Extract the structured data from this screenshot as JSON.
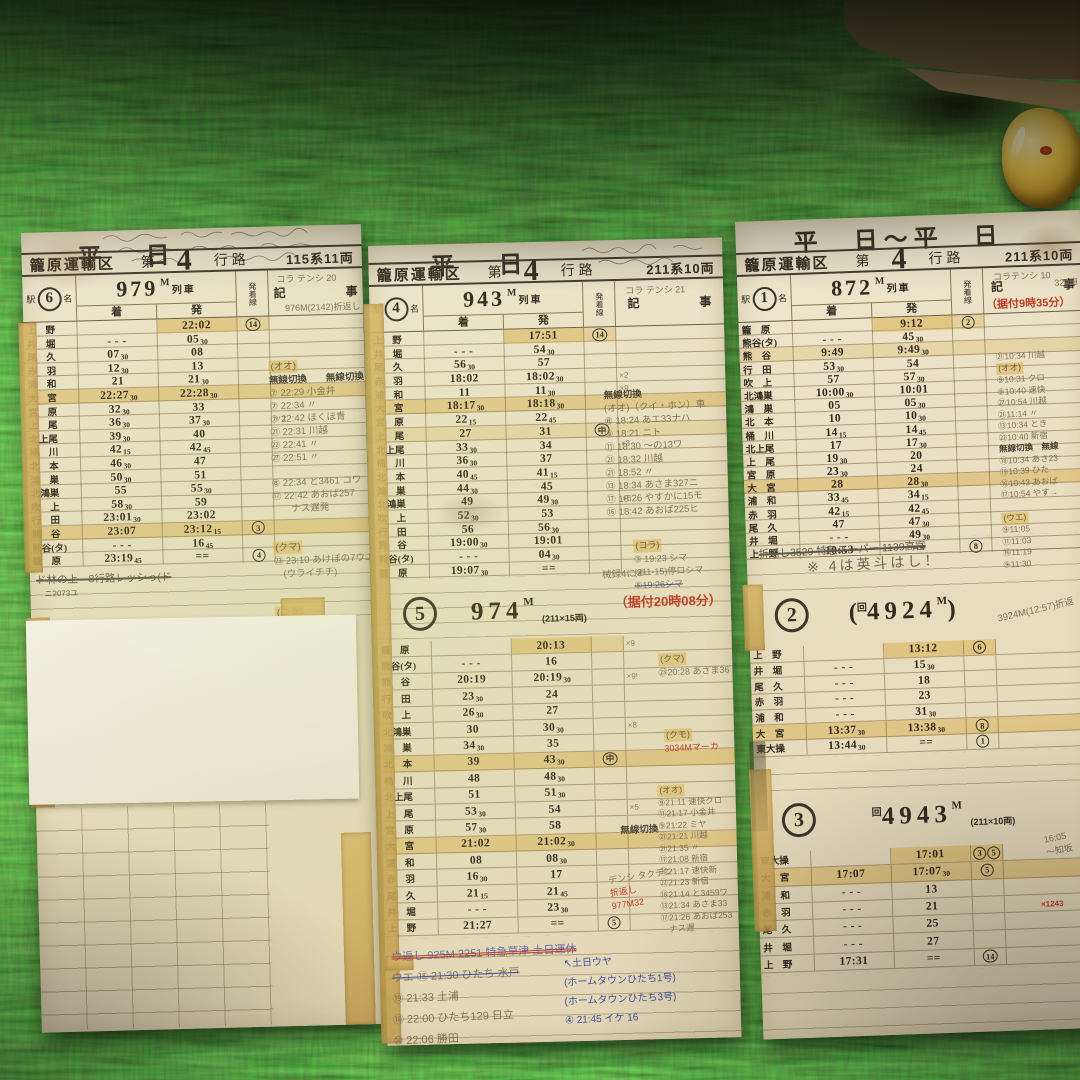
{
  "palette": {
    "carpet": "#2c3a14",
    "card": "#e9dfc3",
    "tape": "#d2ab60",
    "ink": "#33291d",
    "red": "#bf3a27",
    "blue": "#3d4f9e",
    "pencil": "#7d7059"
  },
  "labels": {
    "eki": "駅",
    "mei": "名",
    "arr": "着",
    "dep": "発",
    "track": "発着線",
    "kiji_l": "記",
    "kiji_r": "事",
    "ressha": "列車",
    "m": "M",
    "musen": "無線切換"
  },
  "cards": {
    "left": {
      "title": "平　日",
      "header": {
        "depot": "籠原運輸区",
        "dai": "第",
        "num": "4",
        "koro": "行路",
        "stock": "115系11両"
      },
      "badge": "6",
      "sec1": {
        "train": "979"
      },
      "pencil_top": "コラ テンシ 20",
      "pencil_sub": "976M(2142)折返し",
      "rows": [
        {
          "st": "上　野",
          "d": "22:02",
          "ln": "14",
          "hl": "dep"
        },
        {
          "st": "井　堀",
          "a": "- - -",
          "d": "05",
          "ds": "30"
        },
        {
          "st": "尾　久",
          "a": "07",
          "as": "30",
          "d": "08"
        },
        {
          "st": "赤　羽",
          "a": "12",
          "as": "30",
          "d": "13"
        },
        {
          "st": "浦　和",
          "a": "21",
          "d": "21",
          "ds": "30",
          "m": "19"
        },
        {
          "st": "大　宮",
          "a": "22:27",
          "as": "30",
          "d": "22:28",
          "ds": "30",
          "hl": "row"
        },
        {
          "st": "宮　原",
          "a": "32",
          "as": "30",
          "d": "33"
        },
        {
          "st": "上　尾",
          "a": "36",
          "as": "30",
          "d": "37",
          "ds": "30",
          "m": "〃1"
        },
        {
          "st": "北上尾",
          "a": "39",
          "as": "30",
          "d": "40"
        },
        {
          "st": "桶　川",
          "a": "42",
          "as": "15",
          "d": "42",
          "ds": "45"
        },
        {
          "st": "北　本",
          "a": "46",
          "as": "30",
          "d": "47"
        },
        {
          "st": "鴻　巣",
          "a": "50",
          "as": "30",
          "d": "51"
        },
        {
          "st": "北鴻巣",
          "a": "55",
          "d": "55",
          "ds": "30"
        },
        {
          "st": "吹　上",
          "a": "58",
          "as": "30",
          "d": "59"
        },
        {
          "st": "行　田",
          "a": "23:01",
          "as": "30",
          "d": "23:02"
        },
        {
          "st": "熊　谷",
          "a": "23:07",
          "d": "23:12",
          "ds": "15",
          "ln": "3",
          "hl": "row"
        },
        {
          "st": "熊谷(タ)",
          "a": "- - -",
          "d": "16",
          "ds": "45"
        },
        {
          "st": "籠　原",
          "a": "23:19",
          "as": "45",
          "d": "==",
          "ln": "4"
        }
      ],
      "notes": [
        {
          "t": "(オオ)",
          "c": "hl"
        },
        {
          "t": "無線切換　　無線切換",
          "c": "p2"
        },
        {
          "t": "⑦ 22:29 小金井",
          "c": "p"
        },
        {
          "t": "⑦ 22:34 〃",
          "c": "p"
        },
        {
          "t": "⑦ 22:42 ほくほ青",
          "c": "p"
        },
        {
          "t": "㉑ 22:31 川越",
          "c": "p"
        },
        {
          "t": "㉒ 22:41 〃",
          "c": "p"
        },
        {
          "t": "㉗ 22:51 〃",
          "c": "p"
        },
        {
          "t": "",
          "c": "gap"
        },
        {
          "t": "⑧ 22:34 と3461 コワ",
          "c": "p"
        },
        {
          "t": "⑰ 22:42 あおば257",
          "c": "p"
        },
        {
          "t": "　　ナス遅発",
          "c": "p"
        },
        {
          "t": "",
          "c": "gapL"
        },
        {
          "t": "(クマ)",
          "c": "hl"
        },
        {
          "t": "㉓ 23:10 あけぼの7ウエ",
          "c": "p"
        },
        {
          "t": "　(ウライチチ)",
          "c": "p"
        },
        {
          "t": "",
          "c": "gapL"
        },
        {
          "t": "(コラ)",
          "c": "hl"
        },
        {
          "t": "③ 23:28 折返",
          "c": "p"
        },
        {
          "t": "(211-10)停マ",
          "c": "r"
        }
      ],
      "under_note": "ド林の上　8行路レッシっ(ド",
      "under_note2": "ニ2073ユ",
      "tape_label": "20"
    },
    "middle": {
      "title": "平　日",
      "header": {
        "depot": "籠原運輸区",
        "dai": "第",
        "num": "4",
        "koro": "行路",
        "stock": "211系10両"
      },
      "badge": "4",
      "sec1": {
        "train": "943"
      },
      "pencil_top": "コラ テンシ 21",
      "rows": [
        {
          "st": "上　野",
          "d": "17:51",
          "ln": "14",
          "hl": "dep"
        },
        {
          "st": "井　堀",
          "a": "- - -",
          "d": "54",
          "ds": "30"
        },
        {
          "st": "尾　久",
          "a": "56",
          "as": "30",
          "d": "57"
        },
        {
          "st": "赤　羽",
          "a": "18:02",
          "d": "18:02",
          "ds": "30",
          "m": "×2"
        },
        {
          "st": "浦　和",
          "a": "11",
          "d": "11",
          "ds": "30",
          "m": "×9"
        },
        {
          "st": "大　宮",
          "a": "18:17",
          "as": "30",
          "d": "18:18",
          "ds": "30",
          "hl": "row"
        },
        {
          "st": "宮　原",
          "a": "22",
          "as": "15",
          "d": "22",
          "ds": "45"
        },
        {
          "st": "上　尾",
          "a": "27",
          "d": "31",
          "ln": "中",
          "hl": "rowlight"
        },
        {
          "st": "北上尾",
          "a": "33",
          "as": "30",
          "d": "34",
          "m": "×3"
        },
        {
          "st": "桶　川",
          "a": "36",
          "as": "30",
          "d": "37"
        },
        {
          "st": "北　本",
          "a": "40",
          "as": "45",
          "d": "41",
          "ds": "15"
        },
        {
          "st": "鴻　巣",
          "a": "44",
          "as": "30",
          "d": "45"
        },
        {
          "st": "北鴻巣",
          "a": "49",
          "d": "49",
          "ds": "30",
          "m": "×5"
        },
        {
          "st": "吹　上",
          "a": "52",
          "as": "30",
          "d": "53"
        },
        {
          "st": "行　田",
          "a": "56",
          "d": "56",
          "ds": "30"
        },
        {
          "st": "熊　谷",
          "a": "19:00",
          "as": "30",
          "d": "19:01"
        },
        {
          "st": "熊谷(タ)",
          "a": "- - -",
          "d": "04",
          "ds": "30"
        },
        {
          "st": "籠　原",
          "a": "19:07",
          "as": "30",
          "d": "=="
        }
      ],
      "notes_a": [
        {
          "t": "無線切換",
          "c": "p2"
        },
        {
          "t": "(オオ)（クイ・ホン）車",
          "c": "p"
        },
        {
          "t": "⑧ 18:24 あエ33ナハ",
          "c": "p"
        },
        {
          "t": "⑨ 18:21 ニト",
          "c": "p"
        },
        {
          "t": "⑪ 18:30 〜の13ワ",
          "c": "p"
        },
        {
          "t": "㉑ 18:32 川越",
          "c": "p"
        },
        {
          "t": "㉑ 18:52 〃",
          "c": "p"
        },
        {
          "t": "⑬ 18:34 あさま327ニ",
          "c": "p"
        },
        {
          "t": "⑰ 18:26 やすかに15モ",
          "c": "p"
        },
        {
          "t": "⑯ 18:42 あおば225ヒ",
          "c": "p"
        }
      ],
      "notes_b": [
        {
          "t": "(コラ)",
          "c": "hl"
        },
        {
          "t": "③ 19:23 シマ",
          "c": "p"
        },
        {
          "t": "(211-15)停ロシマ",
          "c": "p"
        },
        {
          "t": "⑤19:26シマ",
          "c": "strike"
        }
      ],
      "notes_b2": "械録4に④",
      "red_note1": "（据付20時08分）",
      "sec2": {
        "badge": "5",
        "train": "974",
        "cars": "(211×15両)"
      },
      "rows2": [
        {
          "st": "籠　原",
          "d": "20:13",
          "hl": "dep",
          "m": "×9"
        },
        {
          "st": "熊谷(タ)",
          "a": "- - -",
          "d": "16"
        },
        {
          "st": "熊　谷",
          "a": "20:19",
          "d": "20:19",
          "ds": "30",
          "m": "×9!"
        },
        {
          "st": "行　田",
          "a": "23",
          "as": "30",
          "d": "24"
        },
        {
          "st": "吹　上",
          "a": "26",
          "as": "30",
          "d": "27"
        },
        {
          "st": "北鴻巣",
          "a": "30",
          "d": "30",
          "ds": "30",
          "m": "×8"
        },
        {
          "st": "鴻　巣",
          "a": "34",
          "as": "30",
          "d": "35"
        },
        {
          "st": "北　本",
          "a": "39",
          "d": "43",
          "ds": "30",
          "ln": "中",
          "hl": "row"
        },
        {
          "st": "桶　川",
          "a": "48",
          "d": "48",
          "ds": "30"
        },
        {
          "st": "北上尾",
          "a": "51",
          "d": "51",
          "ds": "30"
        },
        {
          "st": "上　尾",
          "a": "53",
          "as": "30",
          "d": "54",
          "m": "×5"
        },
        {
          "st": "宮　原",
          "a": "57",
          "as": "30",
          "d": "58"
        },
        {
          "st": "大　宮",
          "a": "21:02",
          "d": "21:02",
          "ds": "30",
          "hl": "row"
        },
        {
          "st": "浦　和",
          "a": "08",
          "d": "08",
          "ds": "30"
        },
        {
          "st": "赤　羽",
          "a": "16",
          "as": "30",
          "d": "17"
        },
        {
          "st": "尾　久",
          "a": "21",
          "as": "15",
          "d": "21",
          "ds": "45"
        },
        {
          "st": "井　堀",
          "a": "- - -",
          "d": "23",
          "ds": "30"
        },
        {
          "st": "上　野",
          "a": "21:27",
          "d": "==",
          "ln": "5"
        }
      ],
      "notes_c": [
        {
          "t": "(クマ)",
          "c": "hl"
        },
        {
          "t": "㉓20:28 あさま36",
          "c": "p"
        }
      ],
      "notes_c2": [
        {
          "t": "(クモ)",
          "c": "hl"
        },
        {
          "t": "3034Mマーカ",
          "c": "r"
        }
      ],
      "musen2": "無線切換",
      "notes_d": [
        {
          "t": "(オオ)",
          "c": "hl"
        },
        {
          "t": "⑨21:11 速快クロ",
          "c": "p"
        },
        {
          "t": "⑪21:17 小金井",
          "c": "p"
        },
        {
          "t": "⑨21:22 ミヤ",
          "c": "p"
        },
        {
          "t": "㉑21:21 川越",
          "c": "p"
        },
        {
          "t": "㉑21:35 〃",
          "c": "p"
        },
        {
          "t": "⑰21:08 新宿",
          "c": "p"
        },
        {
          "t": "⑳21:17 速快新",
          "c": "p"
        },
        {
          "t": "㉒21:23 新宿",
          "c": "p"
        },
        {
          "t": "⑱21:14 と3459ワ",
          "c": "p"
        },
        {
          "t": "⑬21:34 あさま33",
          "c": "p"
        },
        {
          "t": "⑰21:26 あおば253",
          "c": "p"
        },
        {
          "t": "　ナス遅",
          "c": "p"
        }
      ],
      "notes_e": [
        {
          "t": "デンシ タクデン",
          "c": "p"
        },
        {
          "t": "折返し",
          "c": "r"
        },
        {
          "t": "977M32",
          "c": "r"
        }
      ],
      "bottom_notes": [
        {
          "t": "ウ返し 925M 2251 特急草津 土日運休",
          "c": "strike2"
        },
        {
          "t": "ウエ ⑱ 21:30 ひたち 水戸",
          "c": "strikeb"
        },
        {
          "t": "⑲ 21:33 土浦",
          "c": "p"
        },
        {
          "t": "⑱ 22:00 ひたち129 日立",
          "c": "p"
        },
        {
          "t": "⑩ 22:06 勝田",
          "c": "p"
        }
      ],
      "blue_notes": [
        {
          "t": "↖土日ウヤ",
          "c": "b"
        },
        {
          "t": "(ホームタウンひたち1号)",
          "c": "b"
        },
        {
          "t": "(ホームタウンひたち3号)",
          "c": "b"
        },
        {
          "t": "④ 21:45 イケ 16",
          "c": "b"
        }
      ]
    },
    "right": {
      "title": "平　日～平　日",
      "header": {
        "depot": "籠原運輸区",
        "dai": "第",
        "num": "4",
        "koro": "行路",
        "stock": "211系10両"
      },
      "badge": "1",
      "sec1": {
        "train": "872"
      },
      "pencil_top": "コラテンシ 10",
      "pencil_sub": "320車",
      "red_note": "（据付9時35分）",
      "rows": [
        {
          "st": "籠　原",
          "d": "9:12",
          "ln": "2",
          "hl": "dep"
        },
        {
          "st": "熊谷(タ)",
          "a": "- - -",
          "d": "45",
          "ds": "30"
        },
        {
          "st": "熊　谷",
          "a": "9:49",
          "d": "9:49",
          "ds": "30",
          "hl": "rowlight"
        },
        {
          "st": "行　田",
          "a": "53",
          "as": "30",
          "d": "54"
        },
        {
          "st": "吹　上",
          "a": "57",
          "d": "57",
          "ds": "30"
        },
        {
          "st": "北鴻巣",
          "a": "10:00",
          "as": "30",
          "d": "10:01"
        },
        {
          "st": "鴻　巣",
          "a": "05",
          "d": "05",
          "ds": "30"
        },
        {
          "st": "北　本",
          "a": "10",
          "d": "10",
          "ds": "30"
        },
        {
          "st": "桶　川",
          "a": "14",
          "as": "15",
          "d": "14",
          "ds": "45"
        },
        {
          "st": "北上尾",
          "a": "17",
          "d": "17",
          "ds": "30"
        },
        {
          "st": "上　尾",
          "a": "19",
          "as": "30",
          "d": "20"
        },
        {
          "st": "宮　原",
          "a": "23",
          "as": "30",
          "d": "24"
        },
        {
          "st": "大　宮",
          "a": "28",
          "d": "28",
          "ds": "30",
          "hl": "row"
        },
        {
          "st": "浦　和",
          "a": "33",
          "as": "45",
          "d": "34",
          "ds": "15"
        },
        {
          "st": "赤　羽",
          "a": "42",
          "as": "15",
          "d": "42",
          "ds": "45"
        },
        {
          "st": "尾　久",
          "a": "47",
          "d": "47",
          "ds": "30"
        },
        {
          "st": "井　堀",
          "a": "- - -",
          "d": "49",
          "ds": "30"
        },
        {
          "st": "上　野",
          "a": "10:53",
          "d": "==",
          "ln": "8"
        }
      ],
      "under_note": "折返し3529 特急スーパー 1139高宮",
      "under_note2": "※ 4は英斗はし！",
      "notes_a": [
        {
          "t": "㉑10:34 川越",
          "c": "p"
        },
        {
          "t": "(オオ)",
          "c": "hl"
        },
        {
          "t": "⑨10:31 クロ",
          "c": "p"
        },
        {
          "t": "⑨10:40 速快",
          "c": "p"
        },
        {
          "t": "㉗10:54 川越",
          "c": "p"
        },
        {
          "t": "㉑11:14 〃",
          "c": "p"
        },
        {
          "t": "⑬10:34 とき",
          "c": "p"
        },
        {
          "t": "㉒10:40 新宿",
          "c": "p"
        },
        {
          "t": "無線切換　無線",
          "c": "p2"
        },
        {
          "t": "⑱10:34 あさ23",
          "c": "p"
        },
        {
          "t": "⑲10:39 ひた",
          "c": "p"
        },
        {
          "t": "⑯10:43 あおば",
          "c": "p"
        },
        {
          "t": "⑰10:54 やす→",
          "c": "p"
        },
        {
          "t": "",
          "c": "gap"
        },
        {
          "t": "(ウエ)",
          "c": "hl"
        },
        {
          "t": "⑨11:05",
          "c": "p"
        },
        {
          "t": "⑪11:03",
          "c": "p"
        },
        {
          "t": "⑯11:19",
          "c": "p"
        },
        {
          "t": "⑨11:30",
          "c": "p"
        }
      ],
      "sec2": {
        "badge": "2",
        "pre": "(",
        "kai": "回",
        "train": "4924",
        "post": ")"
      },
      "sec2_note": "3924M(12:57)折返",
      "rows2": [
        {
          "st": "上　野",
          "d": "13:12",
          "ln": "6",
          "hl": "deprow"
        },
        {
          "st": "井　堀",
          "a": "- - -",
          "d": "15",
          "ds": "30"
        },
        {
          "st": "尾　久",
          "a": "- - -",
          "d": "18"
        },
        {
          "st": "赤　羽",
          "a": "- - -",
          "d": "23"
        },
        {
          "st": "浦　和",
          "a": "- - -",
          "d": "31",
          "ds": "30"
        },
        {
          "st": "大　宮",
          "a": "13:37",
          "as": "30",
          "d": "13:38",
          "ds": "30",
          "ln": "8",
          "hl": "row"
        },
        {
          "st": "東大操",
          "a": "13:44",
          "as": "30",
          "d": "==",
          "ln": "1"
        }
      ],
      "sec3": {
        "badge": "3",
        "kai": "回",
        "train": "4943",
        "cars": "(211×10両)"
      },
      "sec3_note": [
        "16:05",
        "〜知坂"
      ],
      "red_tiny": "×1243",
      "rows3": [
        {
          "st": "東大操",
          "d": "17:01",
          "ln": "3",
          "ln2": "5",
          "hl": "deprow"
        },
        {
          "st": "大　宮",
          "a": "17:07",
          "d": "17:07",
          "ds": "30",
          "ln": "5",
          "hl": "row"
        },
        {
          "st": "浦　和",
          "a": "- - -",
          "d": "13"
        },
        {
          "st": "赤　羽",
          "a": "- - -",
          "d": "21"
        },
        {
          "st": "尾　久",
          "a": "- - -",
          "d": "25"
        },
        {
          "st": "井　堀",
          "a": "- - -",
          "d": "27"
        },
        {
          "st": "上　野",
          "a": "17:31",
          "d": "==",
          "ln": "14"
        }
      ]
    }
  }
}
